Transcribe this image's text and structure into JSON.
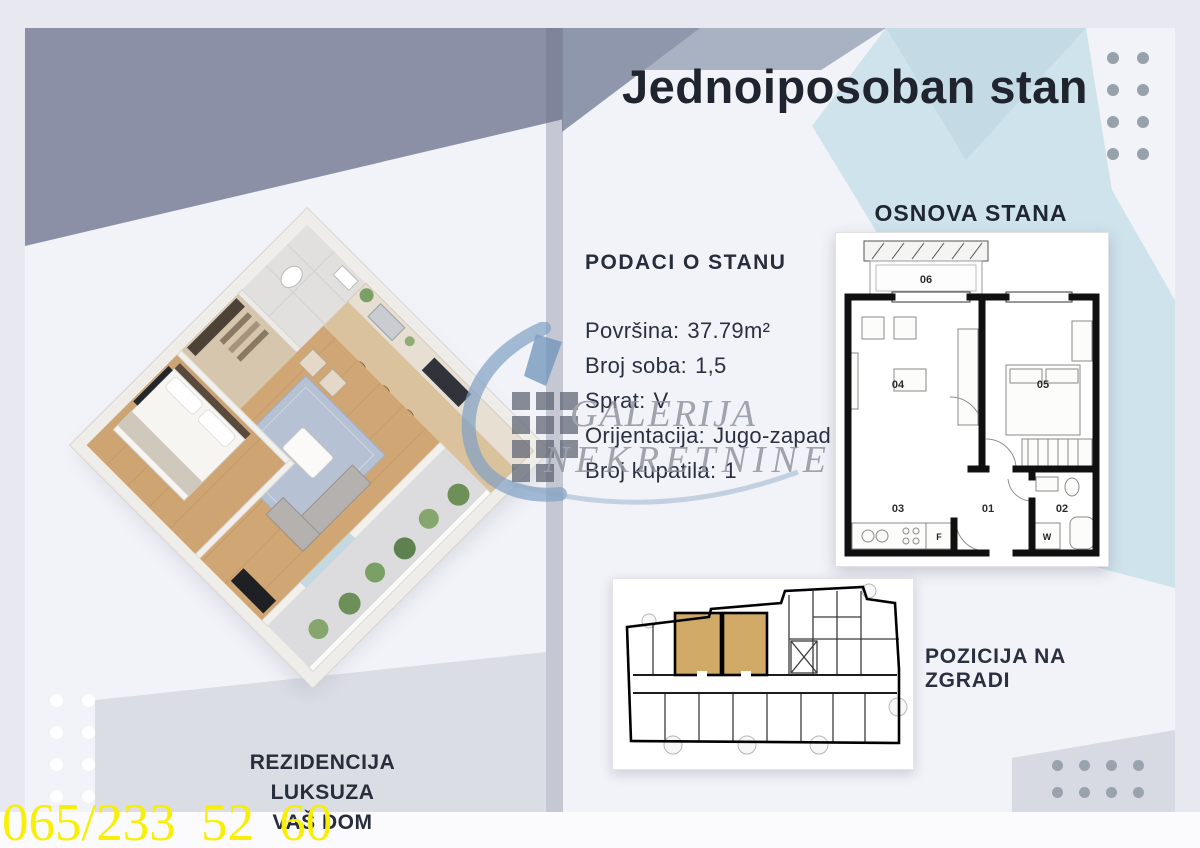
{
  "header": {
    "title": "Jednoiposoban stan"
  },
  "apartment_info": {
    "heading": "PODACI O STANU",
    "rows": [
      {
        "label": "Površina:",
        "value": "37.79m²"
      },
      {
        "label": "Broj soba:",
        "value": "1,5"
      },
      {
        "label": "Sprat:",
        "value": "V"
      },
      {
        "label": "Orijentacija:",
        "value": "Jugo-zapad"
      },
      {
        "label": "Broj kupatila:",
        "value": "1"
      }
    ]
  },
  "floor_plan": {
    "heading": "OSNOVA STANA",
    "room_labels": [
      "01",
      "02",
      "03",
      "04",
      "05",
      "06"
    ],
    "fridge_label": "F",
    "washer_label": "W"
  },
  "building_plan": {
    "heading": "POZICIJA NA ZGRADI",
    "highlight_color": "#d1aa68"
  },
  "watermark": {
    "line1": "GALERIJA",
    "line2": "NEKRETNINE"
  },
  "footer": {
    "tagline_line1": "REZIDENCIJA LUKSUZA",
    "tagline_line2": "VAŠ DOM",
    "phone": "065/233 52 60",
    "phone_color": "#f8ee06"
  },
  "colors": {
    "slate": "#8b90a6",
    "band_blue": "#a9b2c3",
    "pale_blue": "#cfe3ec",
    "text_dark": "#272d3b",
    "dot_gray": "#97a1ac",
    "highlight_tan": "#d1aa68"
  }
}
